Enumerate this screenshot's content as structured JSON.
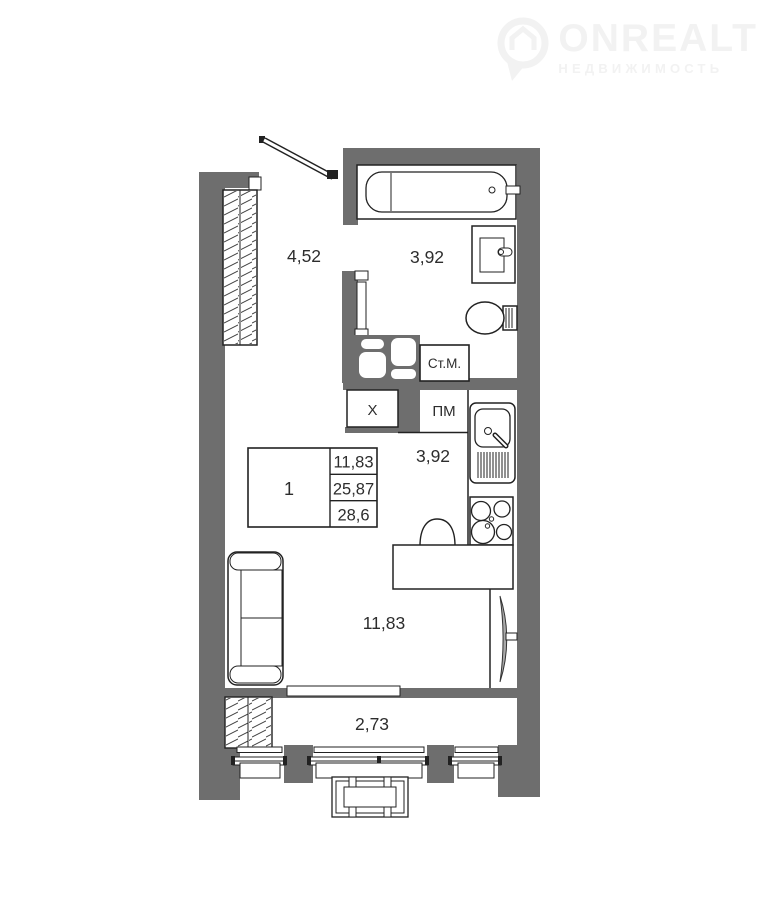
{
  "watermark": {
    "brand": "ONREALT",
    "tagline": "НЕДВИЖИМОСТЬ",
    "color": "#f2f2f2"
  },
  "plan": {
    "rooms": {
      "hall": {
        "area": "4,52"
      },
      "bathroom": {
        "area": "3,92"
      },
      "kitchen": {
        "area": "3,92"
      },
      "living_room": {
        "area": "11,83",
        "number": "1"
      },
      "balcony": {
        "area": "2,73"
      }
    },
    "appliances": {
      "washing_machine": "Ст.М.",
      "fridge": "Х",
      "dishwasher": "ПМ"
    },
    "area_table": {
      "room_number": "1",
      "rows": [
        "11,83",
        "25,87",
        "28,6"
      ]
    },
    "colors": {
      "wall": "#6e6e6e",
      "line": "#222222",
      "text": "#2d2d2d",
      "watermark": "#f2f2f2"
    }
  }
}
